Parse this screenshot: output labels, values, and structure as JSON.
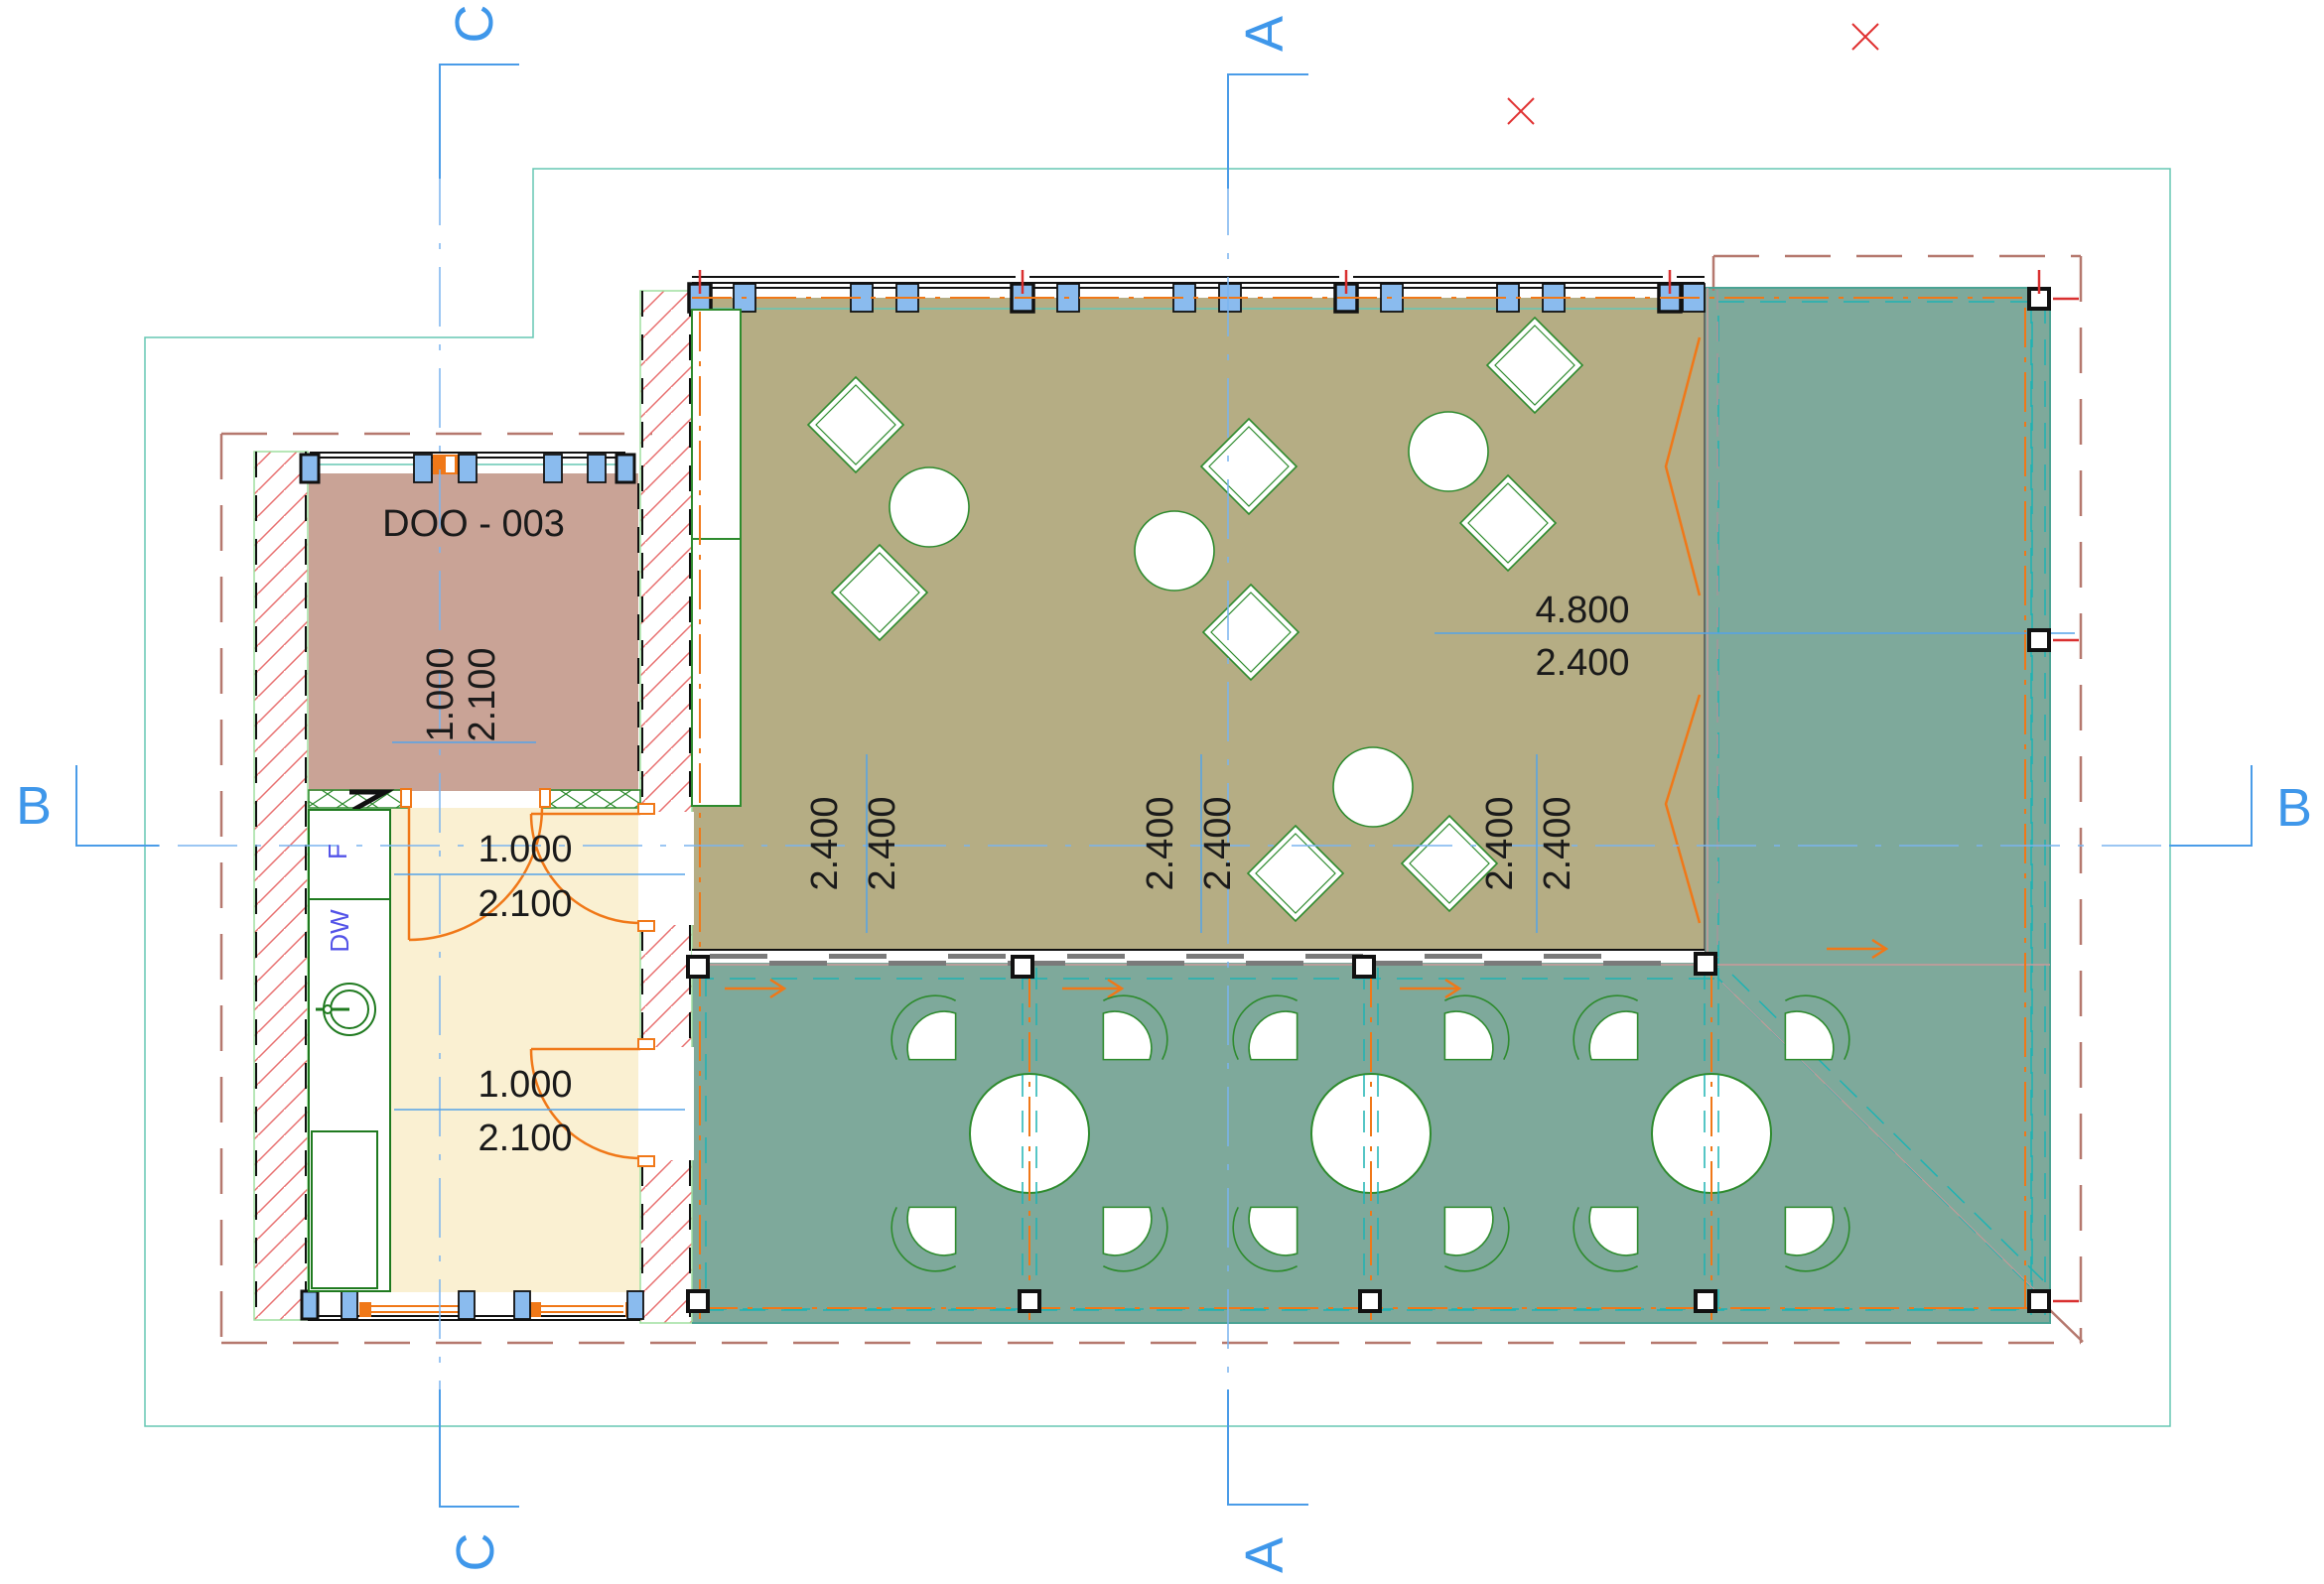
{
  "plan": {
    "room_label": "DOO - 003",
    "appliances": {
      "fridge": "F",
      "dishwasher": "DW"
    },
    "sections": {
      "a": "A",
      "b": "B",
      "c": "C"
    },
    "dims": {
      "door_doo_w": "1.000",
      "door_doo_h": "2.100",
      "door_up_w": "1.000",
      "door_up_h": "2.100",
      "door_low_w": "1.000",
      "door_low_h": "2.100",
      "win_right_w": "4.800",
      "win_right_h": "2.400",
      "bays": [
        "2.400",
        "2.400",
        "2.400",
        "2.400",
        "2.400",
        "2.400"
      ]
    },
    "colors": {
      "section_blue": "#3f97ea",
      "grid_blue": "#7ab4ef",
      "dim_text": "#1a1a1a",
      "deck_teal_fill": "#7ea99b",
      "dining_khaki_fill": "#b5ad84",
      "kitchen_cream_fill": "#faf0d2",
      "room_rose_fill": "#c9a396",
      "door_orange": "#f07818",
      "boundary_rose": "#b5786e",
      "site_teal": "#66c7b4",
      "teal_dash": "#1fb3b3",
      "furniture_green": "#2e8b2e",
      "counter_green": "#1f7a1f",
      "window_blue": "#8abbee",
      "hatch_red": "#e87070",
      "marker_red": "#e03030",
      "appliance_indigo": "#5353e8"
    }
  }
}
